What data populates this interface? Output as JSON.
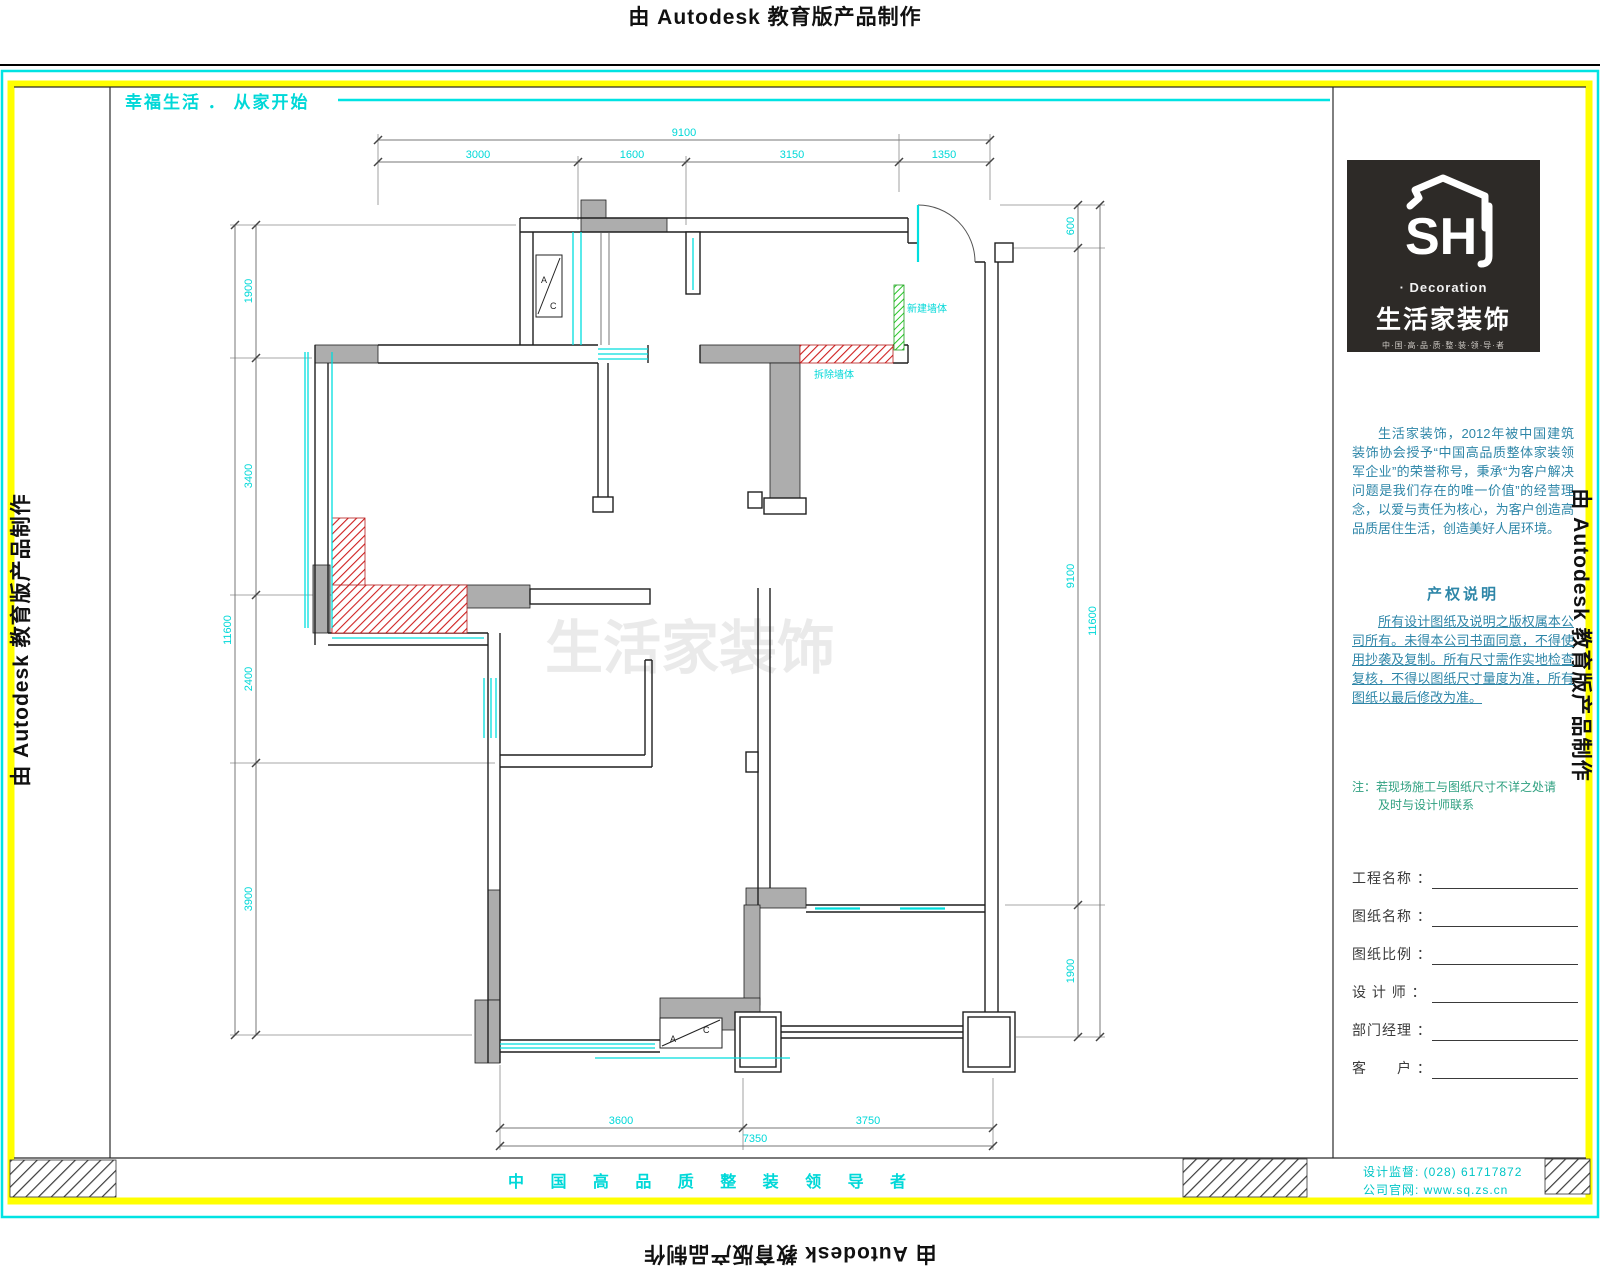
{
  "watermark": {
    "text": "由 Autodesk 教育版产品制作"
  },
  "header": {
    "slogan": "幸福生活 ． 从家开始"
  },
  "plan": {
    "labels": {
      "new_wall": "新建墙体",
      "demolish_wall": "拆除墙体",
      "ac_a": "A",
      "ac_c": "C"
    },
    "ghost_watermark": "生活家装饰"
  },
  "dims": {
    "top": {
      "overall": "9100",
      "segments": [
        "3000",
        "1600",
        "3150",
        "1350"
      ]
    },
    "left": {
      "overall": "11600",
      "segments": [
        "1900",
        "3400",
        "2400",
        "3900"
      ]
    },
    "right": {
      "overall": "11600",
      "segments": [
        "600",
        "9100",
        "1900"
      ]
    },
    "bottom": {
      "overall": "7350",
      "segments": [
        "3600",
        "3750"
      ]
    }
  },
  "title_block": {
    "logo": {
      "sh": "SH",
      "decoration": "· Decoration",
      "brand": "生活家装饰",
      "tagline": "中·国·高·品·质·整·装·领·导·者"
    },
    "intro": "生活家装饰，2012年被中国建筑装饰协会授予“中国高品质整体家装领军企业”的荣誉称号，秉承“为客户解决问题是我们存在的唯一价值”的经营理念，以爱与责任为核心，为客户创造高品质居住生活，创造美好人居环境。",
    "copyright_title": "产权说明",
    "copyright_body": "所有设计图纸及说明之版权属本公司所有。未得本公司书面同意，不得使用抄袭及复制。所有尺寸需作实地检查复核，不得以图纸尺寸量度为准，所有图纸以最后修改为准。",
    "note_line1": "注：若现场施工与图纸尺寸不详之处请",
    "note_line2": "及时与设计师联系",
    "fields": [
      {
        "label": "工程名称 ："
      },
      {
        "label": "图纸名称 ："
      },
      {
        "label": "图纸比例 ："
      },
      {
        "label": "设 计 师 ："
      },
      {
        "label": "部门经理 ："
      },
      {
        "label": "客　　户 ："
      }
    ]
  },
  "footer": {
    "slogan": "中 国 高 品 质 整 装 领 导 者",
    "supervision": "设计监督: (028) 61717872",
    "website": "公司官网: www.sq.zs.cn"
  },
  "colors": {
    "accent_cyan": "#00d8d8",
    "accent_yellow": "#ffff00",
    "wall_gray": "#adadad",
    "demolish_red": "#cf1f1f",
    "new_green": "#28c828",
    "teal_text": "#2e86a8",
    "logo_bg": "#2d2a27"
  }
}
